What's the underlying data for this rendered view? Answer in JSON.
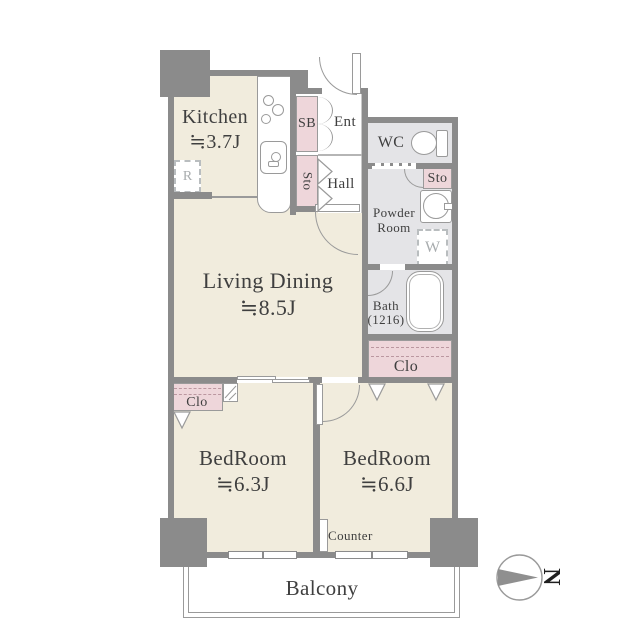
{
  "plan": {
    "rooms": {
      "kitchen": {
        "name": "Kitchen",
        "size": "≒3.7J"
      },
      "living_dining": {
        "name": "Living Dining",
        "size": "≒8.5J"
      },
      "bedroom_left": {
        "name": "BedRoom",
        "size": "≒6.3J"
      },
      "bedroom_right": {
        "name": "BedRoom",
        "size": "≒6.6J"
      },
      "balcony": {
        "name": "Balcony"
      },
      "wc": {
        "name": "WC"
      },
      "powder_room": {
        "name": "Powder Room"
      },
      "bath": {
        "name": "Bath",
        "size": "(1216)"
      },
      "hall": {
        "name": "Hall"
      },
      "entrance": {
        "name": "Ent"
      }
    },
    "storage": {
      "shoe_box": {
        "label": "SB"
      },
      "sto_hall": {
        "label": "Sto"
      },
      "sto_powder": {
        "label": "Sto"
      },
      "closet_left": {
        "label": "Clo"
      },
      "closet_right": {
        "label": "Clo"
      }
    },
    "fixtures": {
      "refrigerator": {
        "label": "R"
      },
      "washer": {
        "label": "W"
      },
      "counter": {
        "label": "Counter"
      }
    },
    "compass": {
      "label": "N"
    },
    "colors": {
      "wall": "#8b8b8b",
      "room_floor": "#f1ecdd",
      "wet_floor": "#e4e4e7",
      "storage_fill": "#eed6da"
    }
  }
}
